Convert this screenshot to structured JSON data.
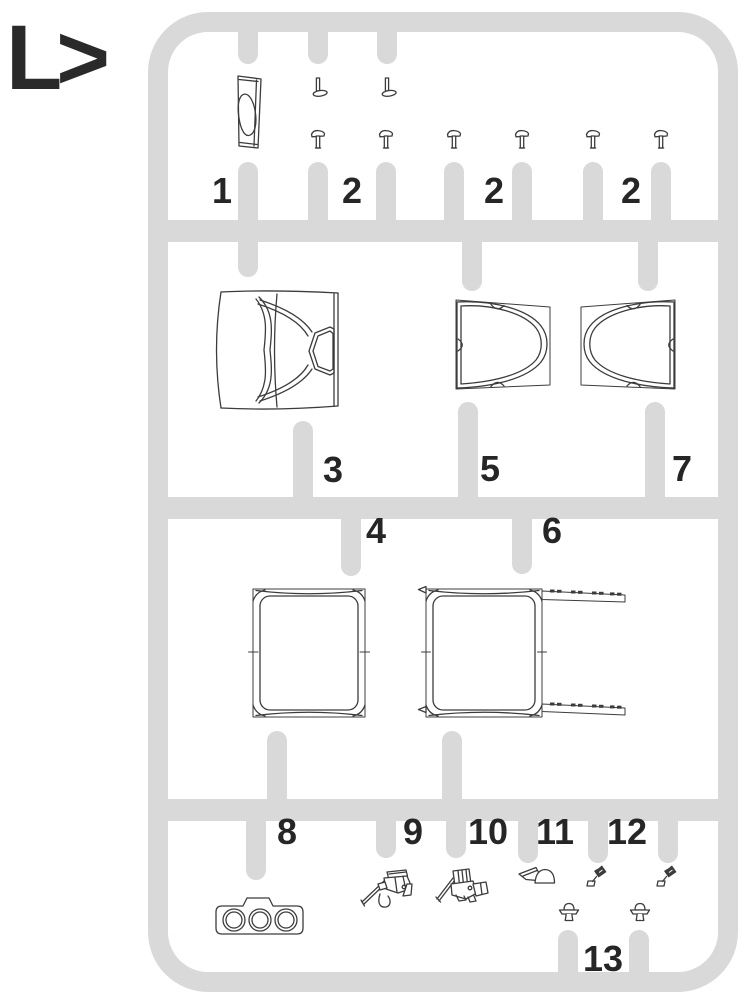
{
  "logo": {
    "text": "L>"
  },
  "colors": {
    "sprue_gray": "#d9d9d9",
    "part_outline": "#3c3c3c",
    "label_text": "#262626",
    "background": "#ffffff"
  },
  "sprue": {
    "name": "sprue-L",
    "rows": 4,
    "description_labels": "part numbers printed beside runner stubs"
  },
  "parts": [
    {
      "number": "1",
      "name": "mirror-housing-panel"
    },
    {
      "number": "2",
      "name": "fastener-pins-group-a"
    },
    {
      "number": "2",
      "name": "fastener-pins-group-b"
    },
    {
      "number": "2",
      "name": "fastener-pins-group-c"
    },
    {
      "number": "3",
      "name": "windscreen-frame"
    },
    {
      "number": "5",
      "name": "side-window-left"
    },
    {
      "number": "7",
      "name": "side-window-right"
    },
    {
      "number": "4",
      "name": "window-pane"
    },
    {
      "number": "6",
      "name": "window-pane-with-rails"
    },
    {
      "number": "8",
      "name": "triple-lamp-plate"
    },
    {
      "number": "9",
      "name": "machine-gun-left"
    },
    {
      "number": "10",
      "name": "machine-gun-right"
    },
    {
      "number": "11",
      "name": "wiper-blade"
    },
    {
      "number": "12",
      "name": "nozzle-pair"
    },
    {
      "number": "13",
      "name": "rivet-caps"
    }
  ]
}
